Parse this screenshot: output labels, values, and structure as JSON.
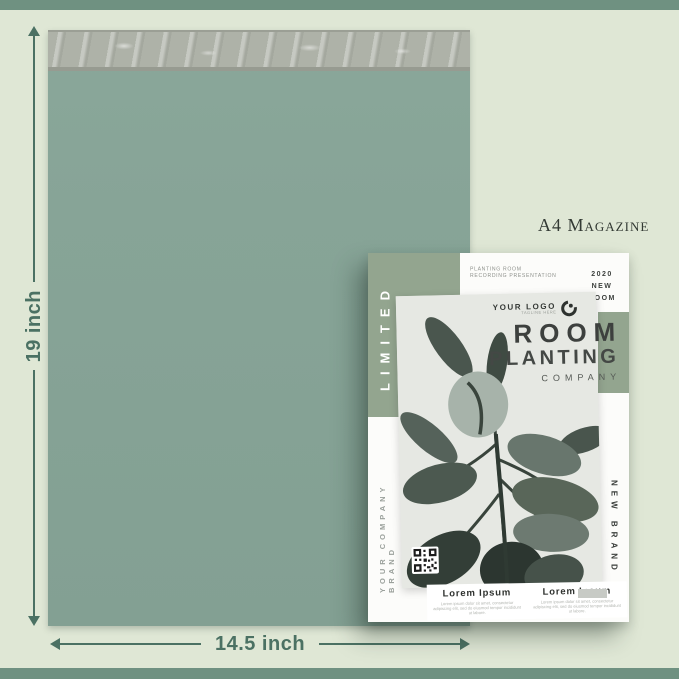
{
  "scene": {
    "annotation_label": "A4 Magazine",
    "height_label": "19 inch",
    "width_label": "14.5 inch"
  },
  "colors": {
    "background": "#dfe7d5",
    "frame_strip": "#6f9181",
    "bag_green": "#87a497",
    "flap_gray": "#aeb2a8",
    "arrow": "#4b7163",
    "sage_block": "#93a58f",
    "photo_bg": "#e6e8e3",
    "title_dark": "#3d403e",
    "leaf_dark": "#303b34",
    "leaf_light": "#a7b3aa"
  },
  "magazine": {
    "limited_label": "LIMITED",
    "category_line1": "PLANTING ROOM",
    "category_line2": "RECORDING PRESENTATION",
    "issue_lines": [
      "2020",
      "NEW",
      "ROOM"
    ],
    "logo_text": "YOUR LOGO",
    "logo_tagline": "TAGLINE HERE",
    "title_line1": "ROOM",
    "title_line2": "PLANTING",
    "title_line3": "COMPANY",
    "left_side_label": "YOUR COMPANY BRAND",
    "right_side_label": "NEW BRAND",
    "footer_columns": [
      {
        "heading": "Lorem Ipsum",
        "body": "Lorem ipsum dolor sit amet, consectetur adipiscing elit, sed do eiusmod tempor incididunt ut labore."
      },
      {
        "heading": "Lorem Ipsum",
        "body": "Lorem ipsum dolor sit amet, consectetur adipiscing elit, sed do eiusmod tempor incididunt ut labore."
      }
    ]
  }
}
